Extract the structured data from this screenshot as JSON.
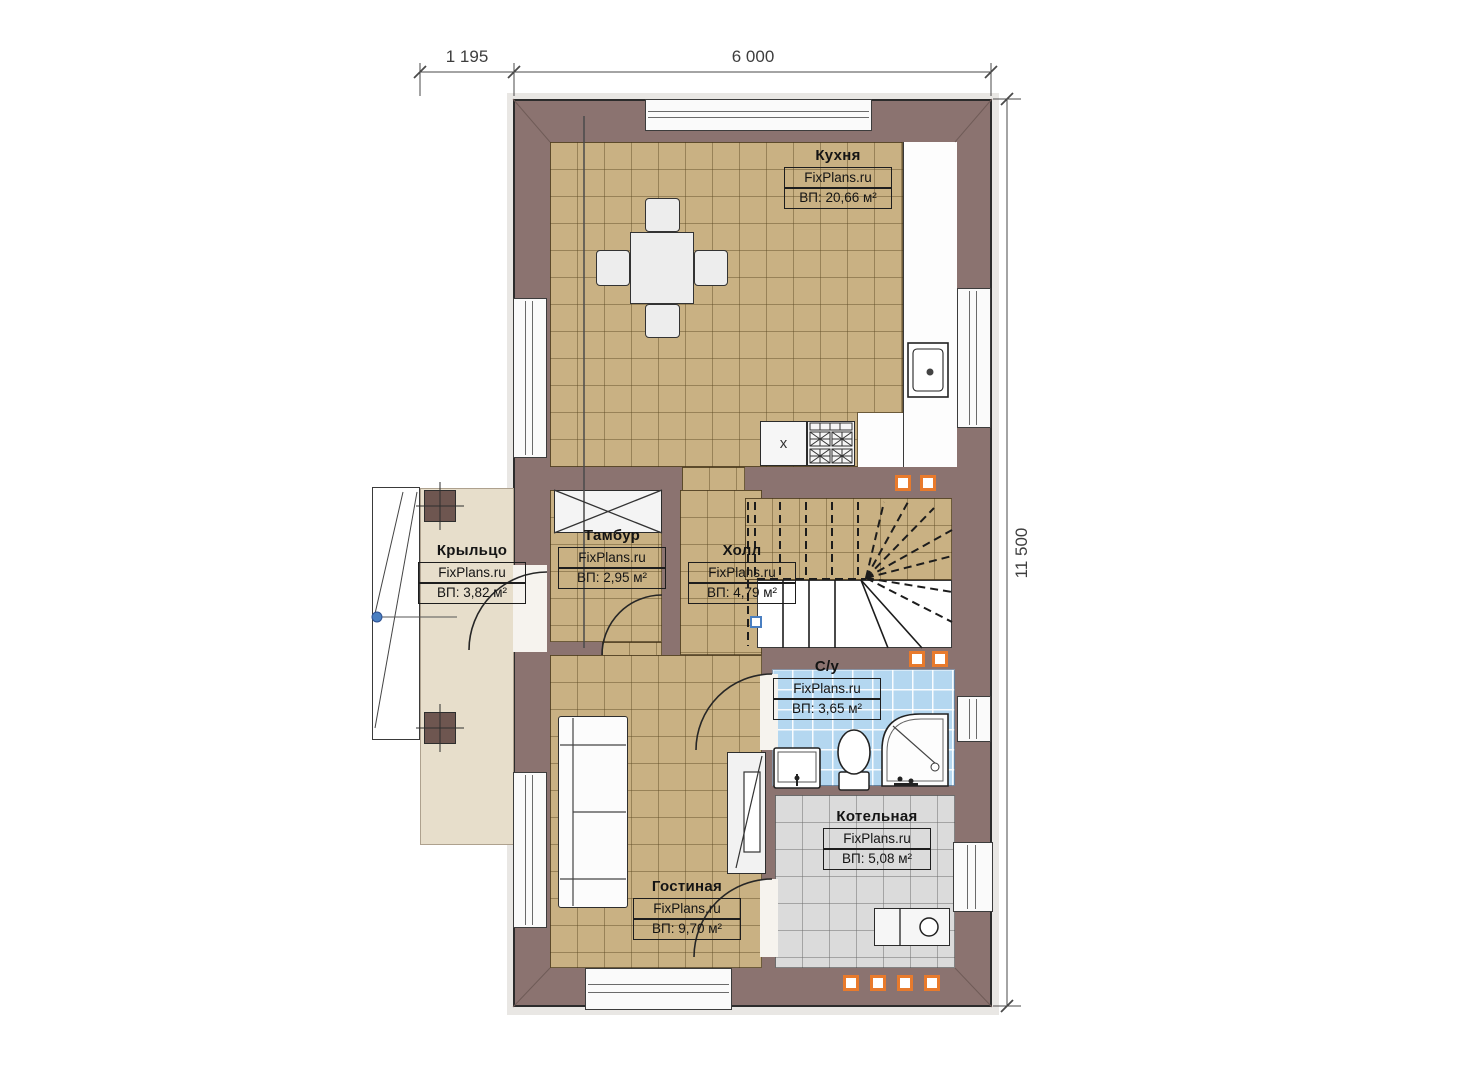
{
  "plan": {
    "watermark": "FixPlans.ru",
    "dimensions": {
      "porch_width": "1 195",
      "building_width": "6 000",
      "building_height": "11 500"
    },
    "rooms": {
      "kitchen": {
        "name": "Кухня",
        "area": "ВП: 20,66 м²"
      },
      "porch": {
        "name": "Крыльцо",
        "area": "ВП: 3,82 м²"
      },
      "tambour": {
        "name": "Тамбур",
        "area": "ВП: 2,95 м²"
      },
      "hall": {
        "name": "Холл",
        "area": "ВП: 4,79 м²"
      },
      "bathroom": {
        "name": "С/у",
        "area": "ВП: 3,65 м²"
      },
      "boiler": {
        "name": "Котельная",
        "area": "ВП: 5,08 м²"
      },
      "living": {
        "name": "Гостиная",
        "area": "ВП: 9,70 м²"
      }
    },
    "labels": {
      "stove_cabinet": "x"
    },
    "colors": {
      "wall": "#8b7370",
      "floor_tile": "#c9b183",
      "porch_floor": "#e7decb",
      "bathroom_tile": "#b4d7f0",
      "boiler_tile": "#dbdbdb",
      "vent_orange": "#e87a2c",
      "marker_blue": "#4a7fc1"
    }
  }
}
